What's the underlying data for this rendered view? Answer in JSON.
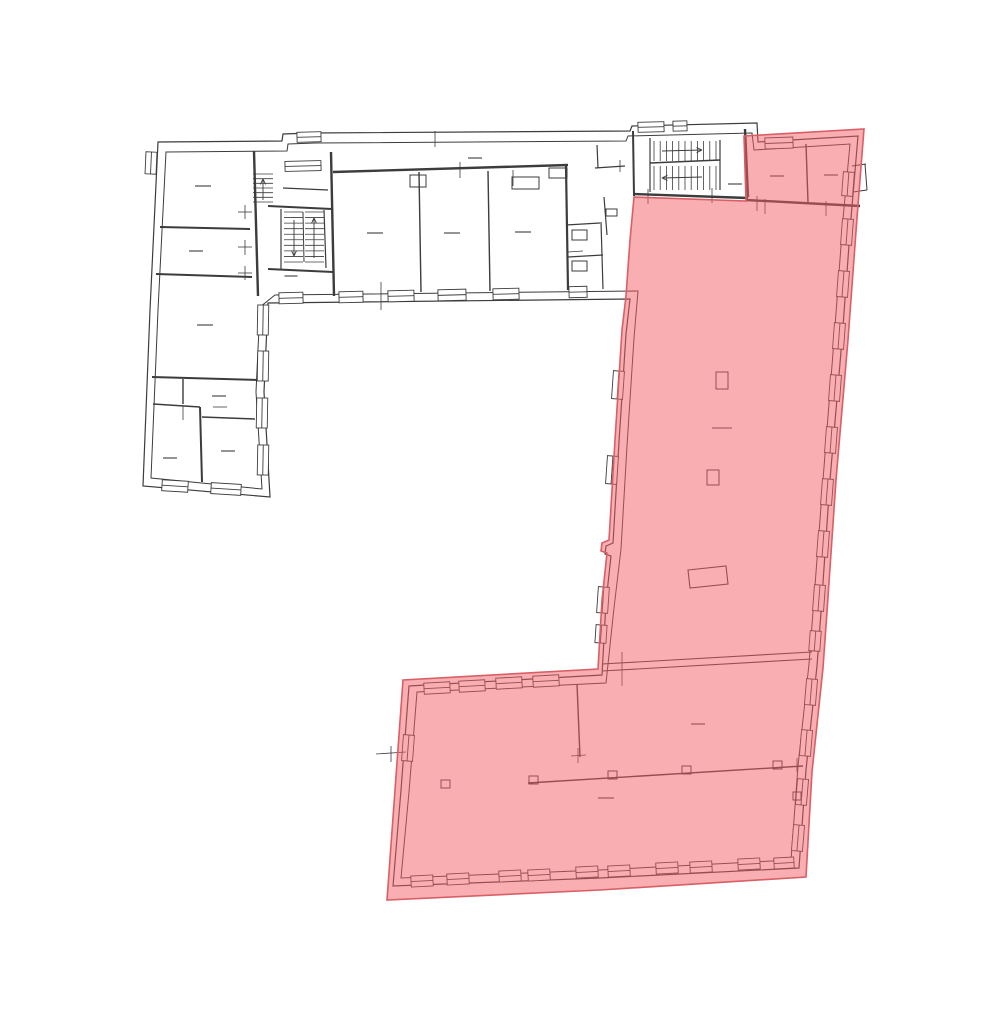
{
  "document": {
    "kind": "floor-plan-drawing",
    "highlight_meaning": "selected-unit-area"
  },
  "colors": {
    "background": "#ffffff",
    "line": "#3c3c3c",
    "window_fill": "#ffffff",
    "highlight_fill": "rgba(243,93,101,0.5)",
    "highlight_stroke": "#d95f66"
  },
  "floorplan": {
    "viewbox": "0 0 1000 1027",
    "line_width": 1.1,
    "highlight": {
      "points": "634,197 746,201 744,136 864,129 857,218 848,340 836,480 827,612 823,668 812,772 806,877 600,890 387,900 395,790 403,680 598,669 602,600 607,553 601,551 602,543 609,540 615,440 622,330 626,296 630,240",
      "stroke_width": 1.6
    },
    "outlines": [
      {
        "points": "158,142 282,141 283,134 311,133 630,131 632,126 757,123 758,142 858,136 851,218 842,340 830,480 821,612 817,666 806,770 799,868 600,878 393,886 401,790 409,686 602,675 606,602 611,556 605,554 606,546 613,543 619,442 626,334 630,299 268,303 264,392 270,497 143,486 150,310",
        "width": 1.2
      },
      {
        "points": "166,152 287,151 288,144 315,143 626,141 628,136 752,133 754,150 850,144 843,219 834,340 823,480 813,612 809,664 798,766 791,860 600,870 401,878 409,792 417,692 606,683 614,608 621,549 627,446 634,338 638,291 275,295 260,307 256,392 262,489 151,478 158,310",
        "width": 1.0
      },
      {
        "points": "688,570 726,566 728,584 690,588",
        "width": 1.1
      }
    ],
    "walls": [
      [
        160,
        227,
        250,
        229,
        2
      ],
      [
        156,
        274,
        252,
        277,
        2
      ],
      [
        152,
        377,
        258,
        380,
        2
      ],
      [
        183,
        379,
        183,
        404,
        1.4
      ],
      [
        153,
        404,
        200,
        407,
        1.4
      ],
      [
        200,
        407,
        202,
        482,
        2
      ],
      [
        202,
        417,
        255,
        419,
        1.4
      ],
      [
        254,
        151,
        258,
        296,
        2.4
      ],
      [
        268,
        206,
        332,
        209,
        2
      ],
      [
        268,
        269,
        333,
        272,
        2
      ],
      [
        331,
        152,
        334,
        296,
        2.4
      ],
      [
        281,
        209,
        281,
        269,
        1.2
      ],
      [
        324,
        210,
        326,
        268,
        1.2
      ],
      [
        303,
        212,
        304,
        262,
        1
      ],
      [
        283,
        188,
        328,
        190,
        1.2
      ],
      [
        333,
        172,
        568,
        165,
        2.4
      ],
      [
        419,
        172,
        421,
        292,
        1.4
      ],
      [
        488,
        171,
        490,
        291,
        1.4
      ],
      [
        566,
        166,
        568,
        290,
        2.2
      ],
      [
        566,
        225,
        600,
        223,
        1.2
      ],
      [
        568,
        257,
        603,
        255,
        1.2
      ],
      [
        601,
        222,
        603,
        289,
        1.2
      ],
      [
        597,
        145,
        598,
        168,
        1.2
      ],
      [
        595,
        168,
        625,
        166,
        1.2
      ],
      [
        604,
        197,
        607,
        235,
        1.2
      ],
      [
        633,
        131,
        634,
        196,
        2
      ],
      [
        634,
        194,
        748,
        198,
        2.4
      ],
      [
        650,
        138,
        650,
        192,
        1.2
      ],
      [
        720,
        140,
        720,
        190,
        1.2
      ],
      [
        650,
        163,
        720,
        160,
        1.4
      ],
      [
        745,
        129,
        748,
        197,
        2.4
      ],
      [
        806,
        144,
        808,
        202,
        1.4
      ],
      [
        746,
        200,
        860,
        206,
        2.4
      ],
      [
        852,
        166,
        866,
        164,
        1
      ],
      [
        853,
        192,
        867,
        190,
        1
      ],
      [
        865,
        164,
        867,
        190,
        1
      ],
      [
        602,
        664,
        812,
        652,
        1.1
      ],
      [
        602,
        671,
        812,
        659,
        1.1
      ],
      [
        577,
        684,
        580,
        757,
        1.4
      ],
      [
        528,
        783,
        803,
        766,
        1.4
      ]
    ],
    "rects": [
      [
        410,
        175,
        16,
        12
      ],
      [
        512,
        177,
        27,
        12
      ],
      [
        549,
        168,
        18,
        10
      ],
      [
        572,
        230,
        15,
        10
      ],
      [
        572,
        261,
        15,
        10
      ],
      [
        606,
        209,
        11,
        7
      ],
      [
        716,
        372,
        12,
        17
      ],
      [
        707,
        470,
        12,
        15
      ],
      [
        529,
        776,
        9,
        8
      ],
      [
        608,
        771,
        9,
        8
      ],
      [
        682,
        766,
        9,
        8
      ],
      [
        773,
        761,
        9,
        8
      ],
      [
        441,
        780,
        9,
        8
      ],
      [
        793,
        792,
        8,
        8
      ]
    ],
    "windows": [
      [
        151,
        163,
        22,
        11,
        92.5
      ],
      [
        175,
        486,
        26,
        11,
        3.5
      ],
      [
        226,
        489,
        30,
        11,
        3.5
      ],
      [
        263,
        320,
        30,
        11,
        91
      ],
      [
        263,
        366,
        30,
        11,
        91
      ],
      [
        262,
        413,
        30,
        11,
        91
      ],
      [
        263,
        460,
        30,
        11,
        91
      ],
      [
        291,
        298,
        24,
        11,
        -1.5
      ],
      [
        351,
        297,
        24,
        11,
        -1.5
      ],
      [
        401,
        296,
        26,
        11,
        -1.5
      ],
      [
        452,
        295,
        28,
        11,
        -1.5
      ],
      [
        506,
        294,
        26,
        11,
        -1.5
      ],
      [
        578,
        292,
        18,
        11,
        -1.5
      ],
      [
        309,
        137,
        24,
        10,
        -1.5
      ],
      [
        303,
        166,
        36,
        10,
        -1.5
      ],
      [
        651,
        127,
        26,
        10,
        -1.5
      ],
      [
        680,
        126,
        14,
        10,
        -1.5
      ],
      [
        779,
        143,
        28,
        11,
        -2
      ],
      [
        848,
        184,
        24,
        11,
        94.3
      ],
      [
        847,
        232,
        26,
        11,
        94.3
      ],
      [
        843,
        284,
        26,
        11,
        94.3
      ],
      [
        839,
        336,
        26,
        11,
        94.3
      ],
      [
        835,
        388,
        26,
        11,
        94.3
      ],
      [
        831,
        440,
        26,
        11,
        94.3
      ],
      [
        827,
        492,
        26,
        11,
        94.3
      ],
      [
        823,
        544,
        26,
        11,
        94.3
      ],
      [
        819,
        598,
        26,
        11,
        94.3
      ],
      [
        815,
        641,
        20,
        11,
        94.3
      ],
      [
        618,
        385,
        28,
        11,
        93.9
      ],
      [
        612,
        470,
        28,
        11,
        93.9
      ],
      [
        603,
        600,
        26,
        11,
        93.9
      ],
      [
        601,
        634,
        18,
        11,
        93.9
      ],
      [
        437,
        688,
        26,
        11,
        -3.2
      ],
      [
        472,
        686,
        26,
        11,
        -3.2
      ],
      [
        509,
        683,
        26,
        11,
        -3.2
      ],
      [
        546,
        681,
        26,
        11,
        -3.2
      ],
      [
        422,
        881,
        22,
        11,
        -3.1
      ],
      [
        458,
        879,
        22,
        11,
        -3.1
      ],
      [
        510,
        876,
        22,
        11,
        -3.1
      ],
      [
        539,
        875,
        22,
        11,
        -3.1
      ],
      [
        587,
        872,
        22,
        11,
        -3.1
      ],
      [
        619,
        871,
        22,
        11,
        -3.1
      ],
      [
        667,
        868,
        22,
        11,
        -3.1
      ],
      [
        701,
        867,
        22,
        11,
        -3.1
      ],
      [
        749,
        864,
        22,
        11,
        -3.1
      ],
      [
        784,
        863,
        20,
        11,
        -3.1
      ],
      [
        811,
        692,
        26,
        11,
        94.7
      ],
      [
        806,
        743,
        26,
        11,
        94.7
      ],
      [
        802,
        792,
        26,
        11,
        94.7
      ],
      [
        798,
        838,
        26,
        11,
        94.7
      ],
      [
        408,
        748,
        26,
        11,
        94.2
      ]
    ],
    "stairs": [
      {
        "x": 654,
        "y": 141,
        "w": 62,
        "h": 20,
        "n": 11,
        "dir": "v"
      },
      {
        "x": 654,
        "y": 166,
        "w": 62,
        "h": 24,
        "n": 11,
        "dir": "v"
      },
      {
        "x": 284,
        "y": 212,
        "w": 19,
        "h": 50,
        "n": 10,
        "dir": "h"
      },
      {
        "x": 305,
        "y": 212,
        "w": 19,
        "h": 50,
        "n": 10,
        "dir": "h"
      },
      {
        "x": 253,
        "y": 174,
        "w": 20,
        "h": 28,
        "n": 7,
        "dir": "h"
      }
    ],
    "arrows": [
      [
        662,
        151,
        702,
        150
      ],
      [
        702,
        177,
        662,
        178
      ],
      [
        294,
        220,
        294,
        256
      ],
      [
        314,
        258,
        314,
        218
      ],
      [
        263,
        200,
        263,
        179
      ]
    ],
    "dashes": [
      [
        203,
        186,
        16
      ],
      [
        196,
        251,
        14
      ],
      [
        205,
        325,
        16
      ],
      [
        219,
        396,
        14
      ],
      [
        170,
        458,
        14
      ],
      [
        228,
        451,
        14
      ],
      [
        375,
        233,
        16
      ],
      [
        452,
        233,
        16
      ],
      [
        523,
        232,
        16
      ],
      [
        475,
        158,
        14
      ],
      [
        291,
        276,
        13
      ],
      [
        735,
        184,
        14
      ],
      [
        777,
        176,
        14
      ],
      [
        831,
        175,
        14
      ],
      [
        722,
        428,
        20
      ],
      [
        698,
        724,
        14
      ],
      [
        606,
        798,
        16
      ]
    ],
    "ticks": [
      [
        238,
        247,
        252,
        247
      ],
      [
        245,
        240,
        245,
        255
      ],
      [
        238,
        212,
        252,
        212
      ],
      [
        245,
        205,
        245,
        219
      ],
      [
        238,
        273,
        252,
        273
      ],
      [
        245,
        266,
        245,
        280
      ],
      [
        460,
        162,
        460,
        178
      ],
      [
        513,
        170,
        513,
        186
      ],
      [
        381,
        282,
        381,
        310
      ],
      [
        435,
        131,
        435,
        147
      ],
      [
        620,
        160,
        620,
        172
      ],
      [
        648,
        189,
        648,
        204
      ],
      [
        712,
        188,
        712,
        203
      ],
      [
        757,
        196,
        757,
        211
      ],
      [
        765,
        199,
        765,
        214
      ],
      [
        826,
        201,
        826,
        216
      ],
      [
        568,
        252,
        583,
        251
      ],
      [
        622,
        652,
        622,
        686
      ],
      [
        578,
        748,
        578,
        763
      ],
      [
        571,
        756,
        586,
        755
      ],
      [
        797,
        758,
        797,
        772
      ],
      [
        391,
        746,
        391,
        762
      ],
      [
        376,
        754,
        406,
        752
      ],
      [
        183,
        406,
        183,
        420
      ],
      [
        213,
        407,
        227,
        407
      ]
    ]
  }
}
